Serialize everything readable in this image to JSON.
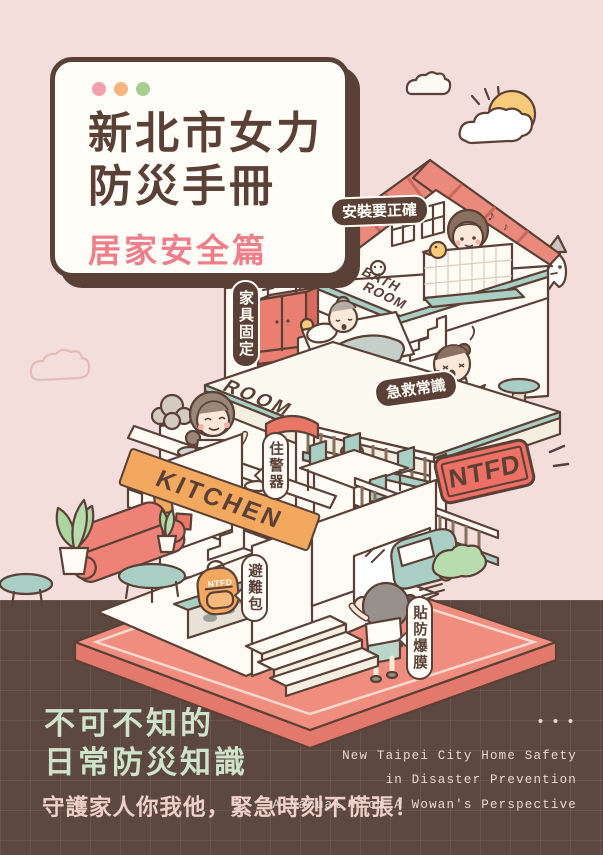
{
  "title_card": {
    "title_line1": "新北市女力",
    "title_line2": "防災手冊",
    "subtitle": "居家安全篇",
    "window_dot_colors": [
      "#f2a0ae",
      "#f5b57e",
      "#a8cf92"
    ]
  },
  "house": {
    "labels": {
      "install_correctly": "安裝要正確",
      "furniture_fixed": "家具固定",
      "bath_line1": "BATH",
      "bath_line2": "ROOM",
      "room": "ROOM",
      "first_aid": "急救常識",
      "kitchen": "KITCHEN",
      "smoke_alarm": "住警器",
      "ntfd_sign": "NTFD",
      "go_bag": "避難包",
      "backpack_logo": "NTFD",
      "shatterproof_film": "貼防爆膜"
    },
    "music_notes": [
      "♪",
      "♪"
    ]
  },
  "footer": {
    "headline_line1": "不可不知的",
    "headline_line2": "日常防災知識",
    "tagline": "守護家人你我他，緊急時刻不慌張！",
    "dots": "•••",
    "en_line1": "New Taipei City Home Safety",
    "en_line2": "in Disaster Prevention",
    "en_line3": "A Manual from A Wowan's Perspective"
  },
  "colors": {
    "background_pink": "#f4dedb",
    "background_brown": "#5c4840",
    "outline_brown": "#5a4036",
    "roof_salmon": "#e98a7c",
    "deep_red": "#e87767",
    "ntfd_red": "#ec7065",
    "orange": "#f2a85f",
    "teal": "#a9cec3",
    "sun_yellow": "#f8cb7b",
    "bush_green": "#b9dcae",
    "subtitle_pink": "#ee7e8a",
    "footer_mint": "#cfe3cc",
    "footer_pink": "#eecfca",
    "footer_cream": "#e9d8d0"
  }
}
